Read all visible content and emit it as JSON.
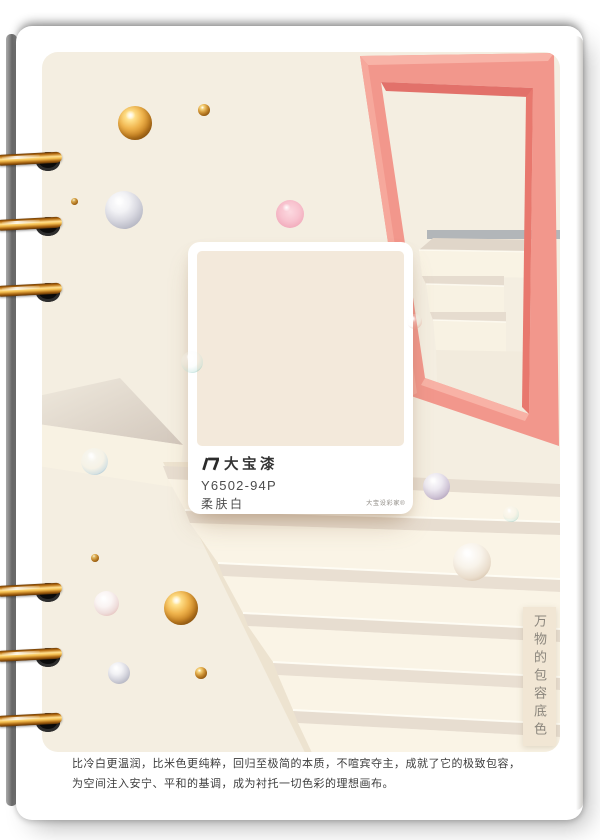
{
  "poster": {
    "card": {
      "brand": "大宝漆",
      "code": "Y6502-94P",
      "name": "柔肤白",
      "trademark": "大宝设彩家®"
    },
    "side_label": "万物的包容底色",
    "description": {
      "line1": "比冷白更温润，比米色更纯粹，回归至极简的本质，不喧宾夺主，成就了它的极致包容，",
      "line2": "为空间注入安宁、平和的基调，成为衬托一切色彩的理想画布。"
    },
    "colors": {
      "poster_bg": "#F4EEE1",
      "swatch": "#F3E9DB",
      "frame": "#F2978C",
      "frame_highlight": "#F8B2A6",
      "frame_shadow": "#E2716A",
      "gray_band": "#A6ACB2",
      "stair_tread": "#E7DDD0",
      "stair_riser": "#FAF4E6",
      "gold": "#E8A93F"
    }
  }
}
